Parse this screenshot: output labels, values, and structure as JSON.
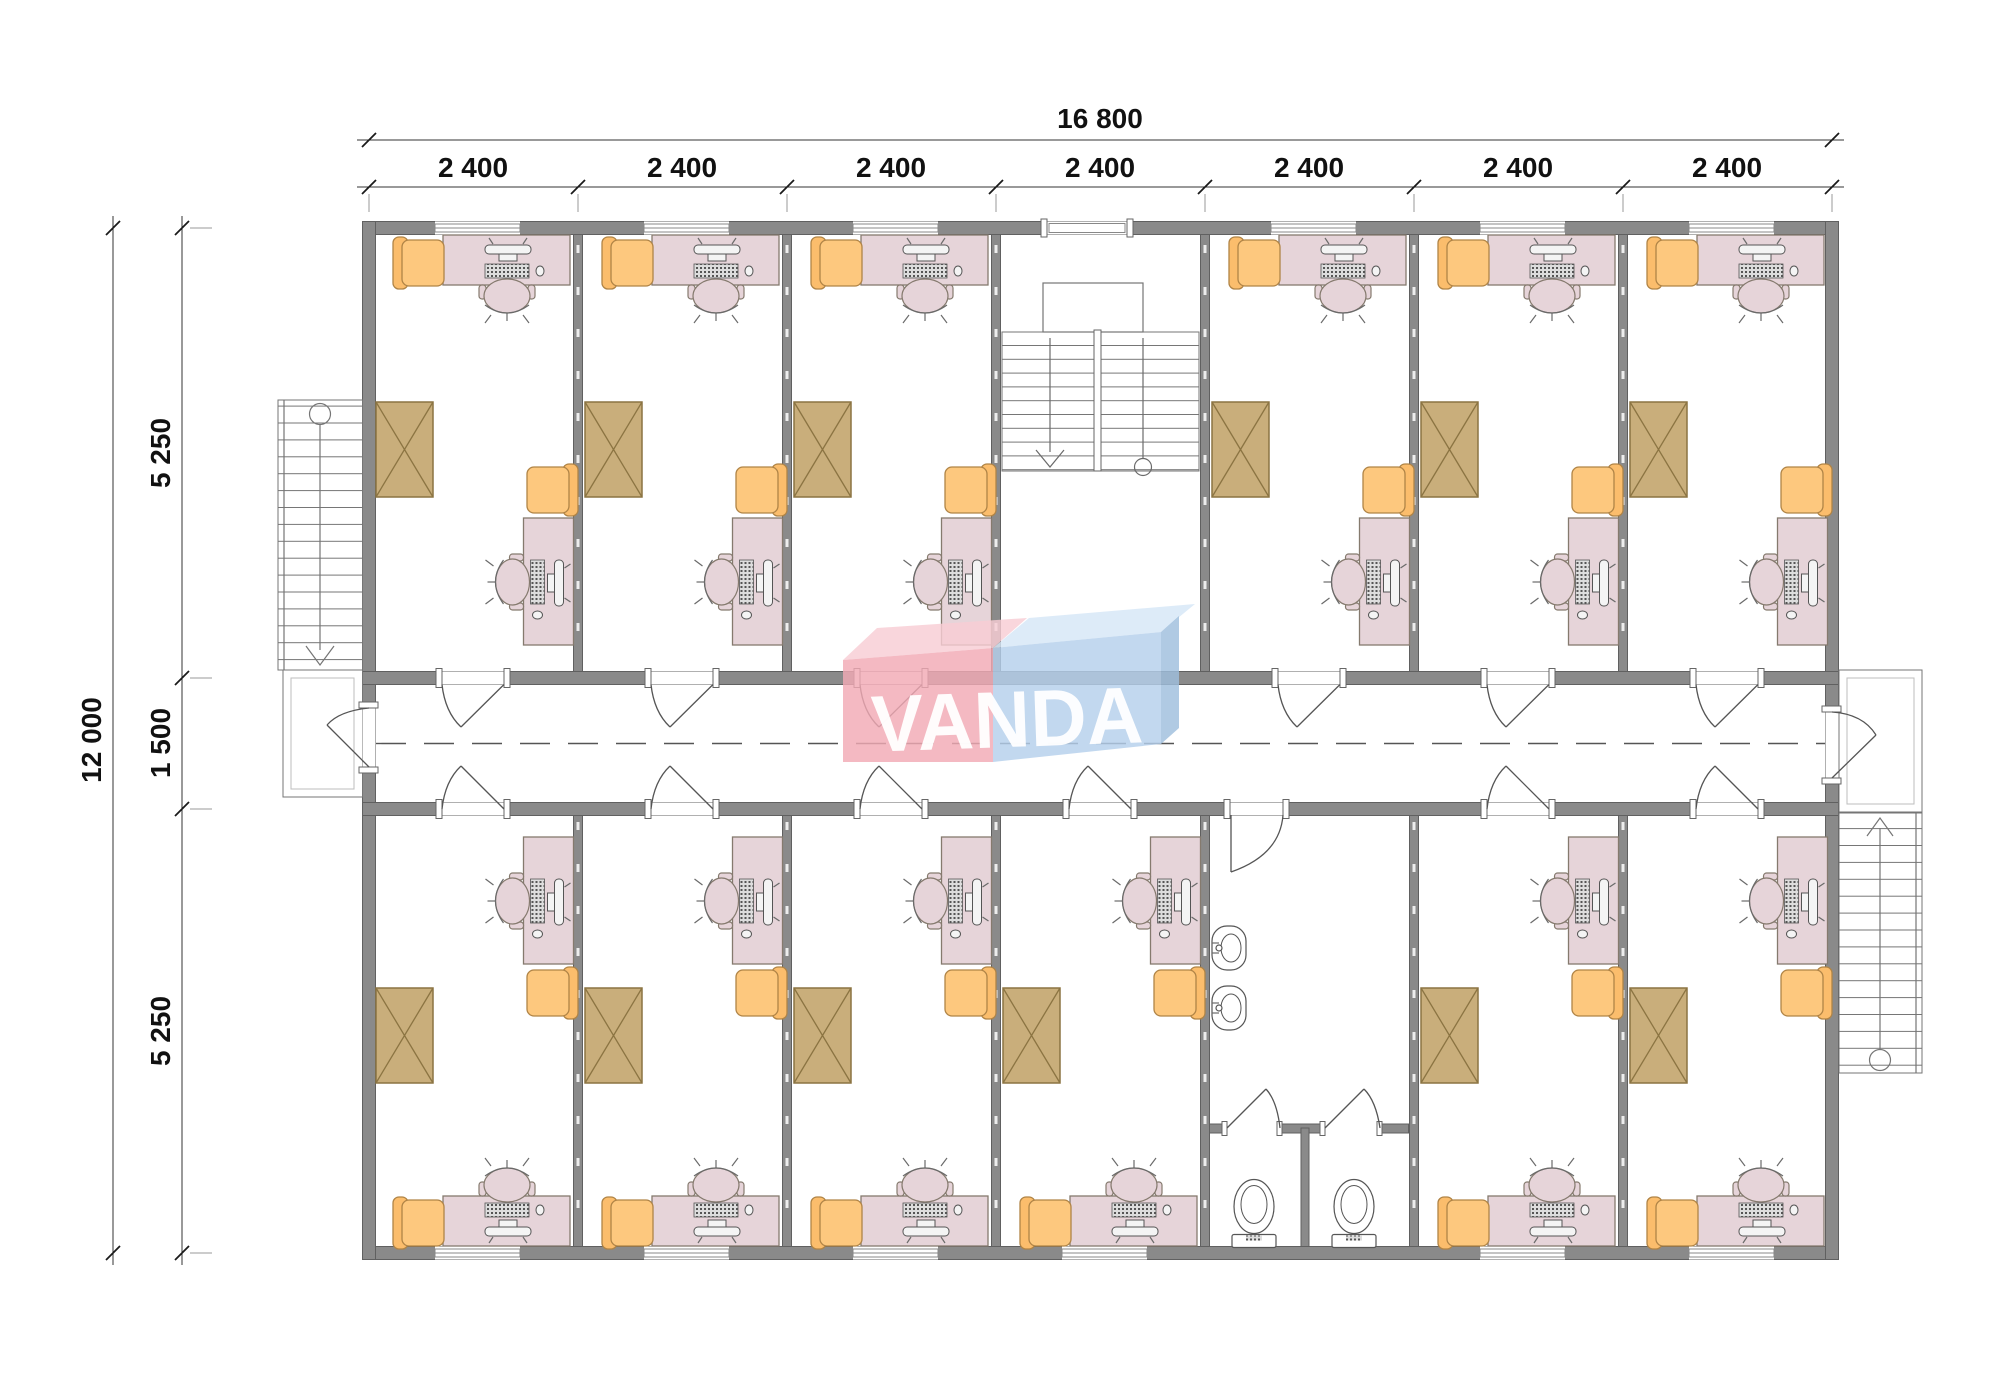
{
  "page": {
    "type": "architectural floor plan",
    "background": "#ffffff"
  },
  "dimensions": {
    "top_overall": "16 800",
    "top_segments": [
      "2 400",
      "2 400",
      "2 400",
      "2 400",
      "2 400",
      "2 400",
      "2 400"
    ],
    "left_overall": "12 000",
    "left_segments": [
      "5 250",
      "1 500",
      "5 250"
    ]
  },
  "logo": {
    "text": "VANDA",
    "pink_face": "#f2a9b4",
    "pink_top": "#f8cdd4",
    "blue_face": "#b5d0ec",
    "blue_top": "#d6e6f7",
    "blue_side": "#9fbedd",
    "text_color": "#ffffff"
  },
  "palette": {
    "wall": "#8a8a8a",
    "wall_outline": "#606060",
    "desk": "#e6d4d9",
    "desk_outline": "#857a6e",
    "armchair": "#fdc87e",
    "armchair_outline": "#b08446",
    "crate": "#c9ae7b",
    "crate_outline": "#8b7442",
    "drawing_line": "#4d4d4d",
    "dimension_text": "#111111"
  },
  "plan": {
    "corridor": "central corridor with dashed axis line",
    "offices_top_row": 6,
    "offices_bottom_row": 6,
    "workstations_per_office": 2,
    "armchairs_per_office": 2,
    "storage_crates_per_office": 1,
    "stairwells_internal": 1,
    "stairs_external": 2,
    "bathroom_toilets": 2,
    "bathroom_wash_basins": 2
  }
}
